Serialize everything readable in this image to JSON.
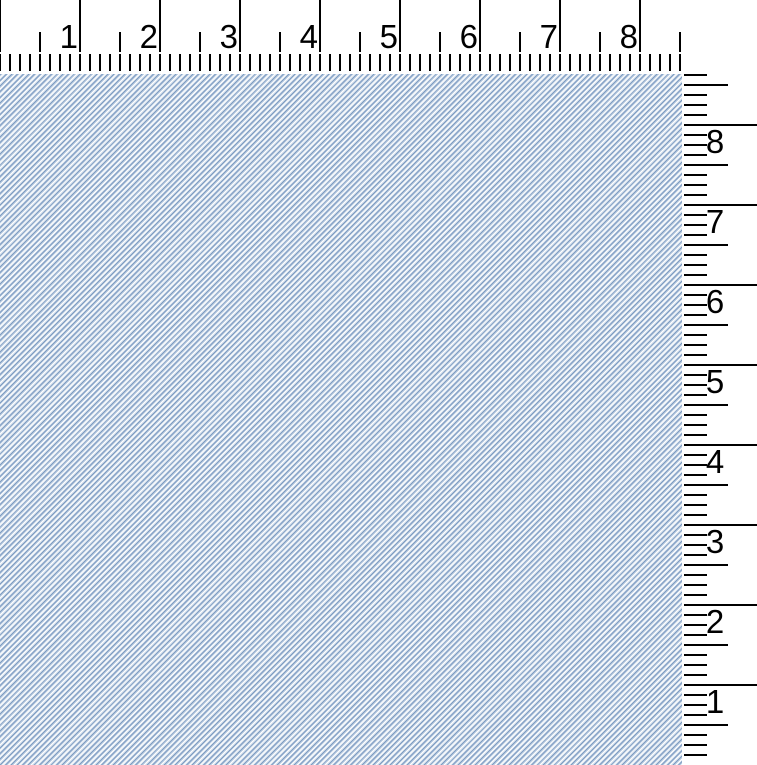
{
  "window": {
    "width_px": 757,
    "height_px": 765,
    "background": "#ffffff"
  },
  "horizontal_ruler": {
    "units": "inches",
    "pixels_per_inch": 80,
    "divisions_per_inch": 8,
    "labels": [
      "1",
      "2",
      "3",
      "4",
      "5",
      "6",
      "7",
      "8"
    ],
    "direction": "left-to-right",
    "label_color": "#000000"
  },
  "vertical_ruler": {
    "units": "inches",
    "pixels_per_inch": 80,
    "divisions_per_inch": 8,
    "labels": [
      "8",
      "7",
      "6",
      "5",
      "4",
      "3",
      "2",
      "1"
    ],
    "direction": "bottom-to-top",
    "label_color": "#000000"
  },
  "colors": {
    "tick": "#000000",
    "label": "#000000",
    "ruler_background": "#ffffff",
    "swatch_blue": "#7e9cc2",
    "swatch_mid_blue": "#b9cbe0",
    "swatch_highlight": "#ffffff",
    "swatch_light_blue": "#dde6f0"
  },
  "swatch": {
    "pattern": "diagonal-twill-weave",
    "stripe_direction": "/",
    "stripe_period_px": 4
  }
}
